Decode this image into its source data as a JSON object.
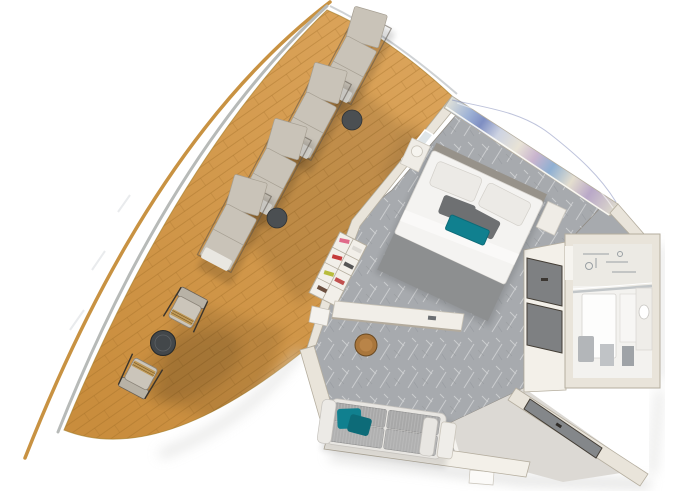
{
  "meta": {
    "title": "3D floor plan render of a cruise-ship stateroom with large wraparound balcony",
    "view": "top-down 3d cutaway"
  },
  "scene": {
    "balcony": {
      "label": "wraparound-teak-balcony",
      "lounger_count": 4,
      "lounger_side_tables": 2,
      "dining_chairs": 2,
      "dining_tables": 1,
      "railing": "curved-glass-and-wood-rail"
    },
    "bedroom": {
      "label": "bedroom",
      "items": [
        "double-bed",
        "gray-bed-runner",
        "teal-accent-pillow",
        "nightstand",
        "table-lamp",
        "wave-pattern-art-wall",
        "shoe-shelf",
        "balcony-door"
      ]
    },
    "living_area": {
      "label": "living-area",
      "items": [
        "sofa",
        "teal-throw-pillows",
        "side-table",
        "desk",
        "round-stool"
      ]
    },
    "bathroom": {
      "label": "bathroom",
      "items": [
        "shower",
        "toilet",
        "vanity-sink",
        "floor-mat"
      ]
    },
    "entry": {
      "label": "entry-hall",
      "items": [
        "entrance-door",
        "wardrobe-closet-doors",
        "vinyl-floor",
        "door-step"
      ]
    }
  },
  "colors": {
    "background": "#ffffff",
    "deck_wood_light": "#dca55c",
    "deck_wood": "#c98d3d",
    "rail_wood": "#c89242",
    "deck_edge_gray": "#b7bab8",
    "lounger_cushion": "#c9c3b8",
    "lounger_pillow": "#e9e7e1",
    "lounger_frame": "#5a5248",
    "side_table_dark": "#4b4f52",
    "chair_cushion": "#cbc5ba",
    "chair_wood": "#c09a58",
    "dining_table_dark": "#43474a",
    "carpet_gray": "#a7aaae",
    "wall_cream": "#e9e4da",
    "wall_light": "#f3f0e9",
    "wall_edge": "#b5ae9f",
    "closet_door_gray": "#7e8082",
    "door_frame_dark": "#433d35",
    "entry_door_gray": "#84878a",
    "vinyl_floor": "#dcd9d4",
    "bath_floor": "#f3f2ef",
    "fixture_white": "#fdfdfc",
    "fixture_gray": "#b3b6b9",
    "bed_duvet": "#f4f3f1",
    "bed_runner_gray": "#8d8f90",
    "pillow_gray": "#6e7072",
    "teal_accent": "#10808f",
    "teal_dark": "#0d6b78",
    "sofa_cushion": "#a8a8a8",
    "sofa_frame": "#e8e6e2",
    "stool_brown": "#a9763c",
    "art_stop_0": "#dfe0d8",
    "art_stop_1": "#9fb3d6",
    "art_stop_2": "#7e8ec2",
    "art_stop_3": "#cdd3e2",
    "art_stop_4": "#e8e3d6",
    "art_stop_5": "#c9b4ce",
    "art_stop_6": "#8fb0d2",
    "art_stop_7": "#e4decf",
    "art_stop_8": "#b9a8c8",
    "art_stop_9": "#dcd8cc",
    "shoe_pink": "#e06a8a",
    "shoe_red": "#c43b3b",
    "shoe_yellow": "#b8bc3c",
    "shoe_dark": "#555555"
  }
}
